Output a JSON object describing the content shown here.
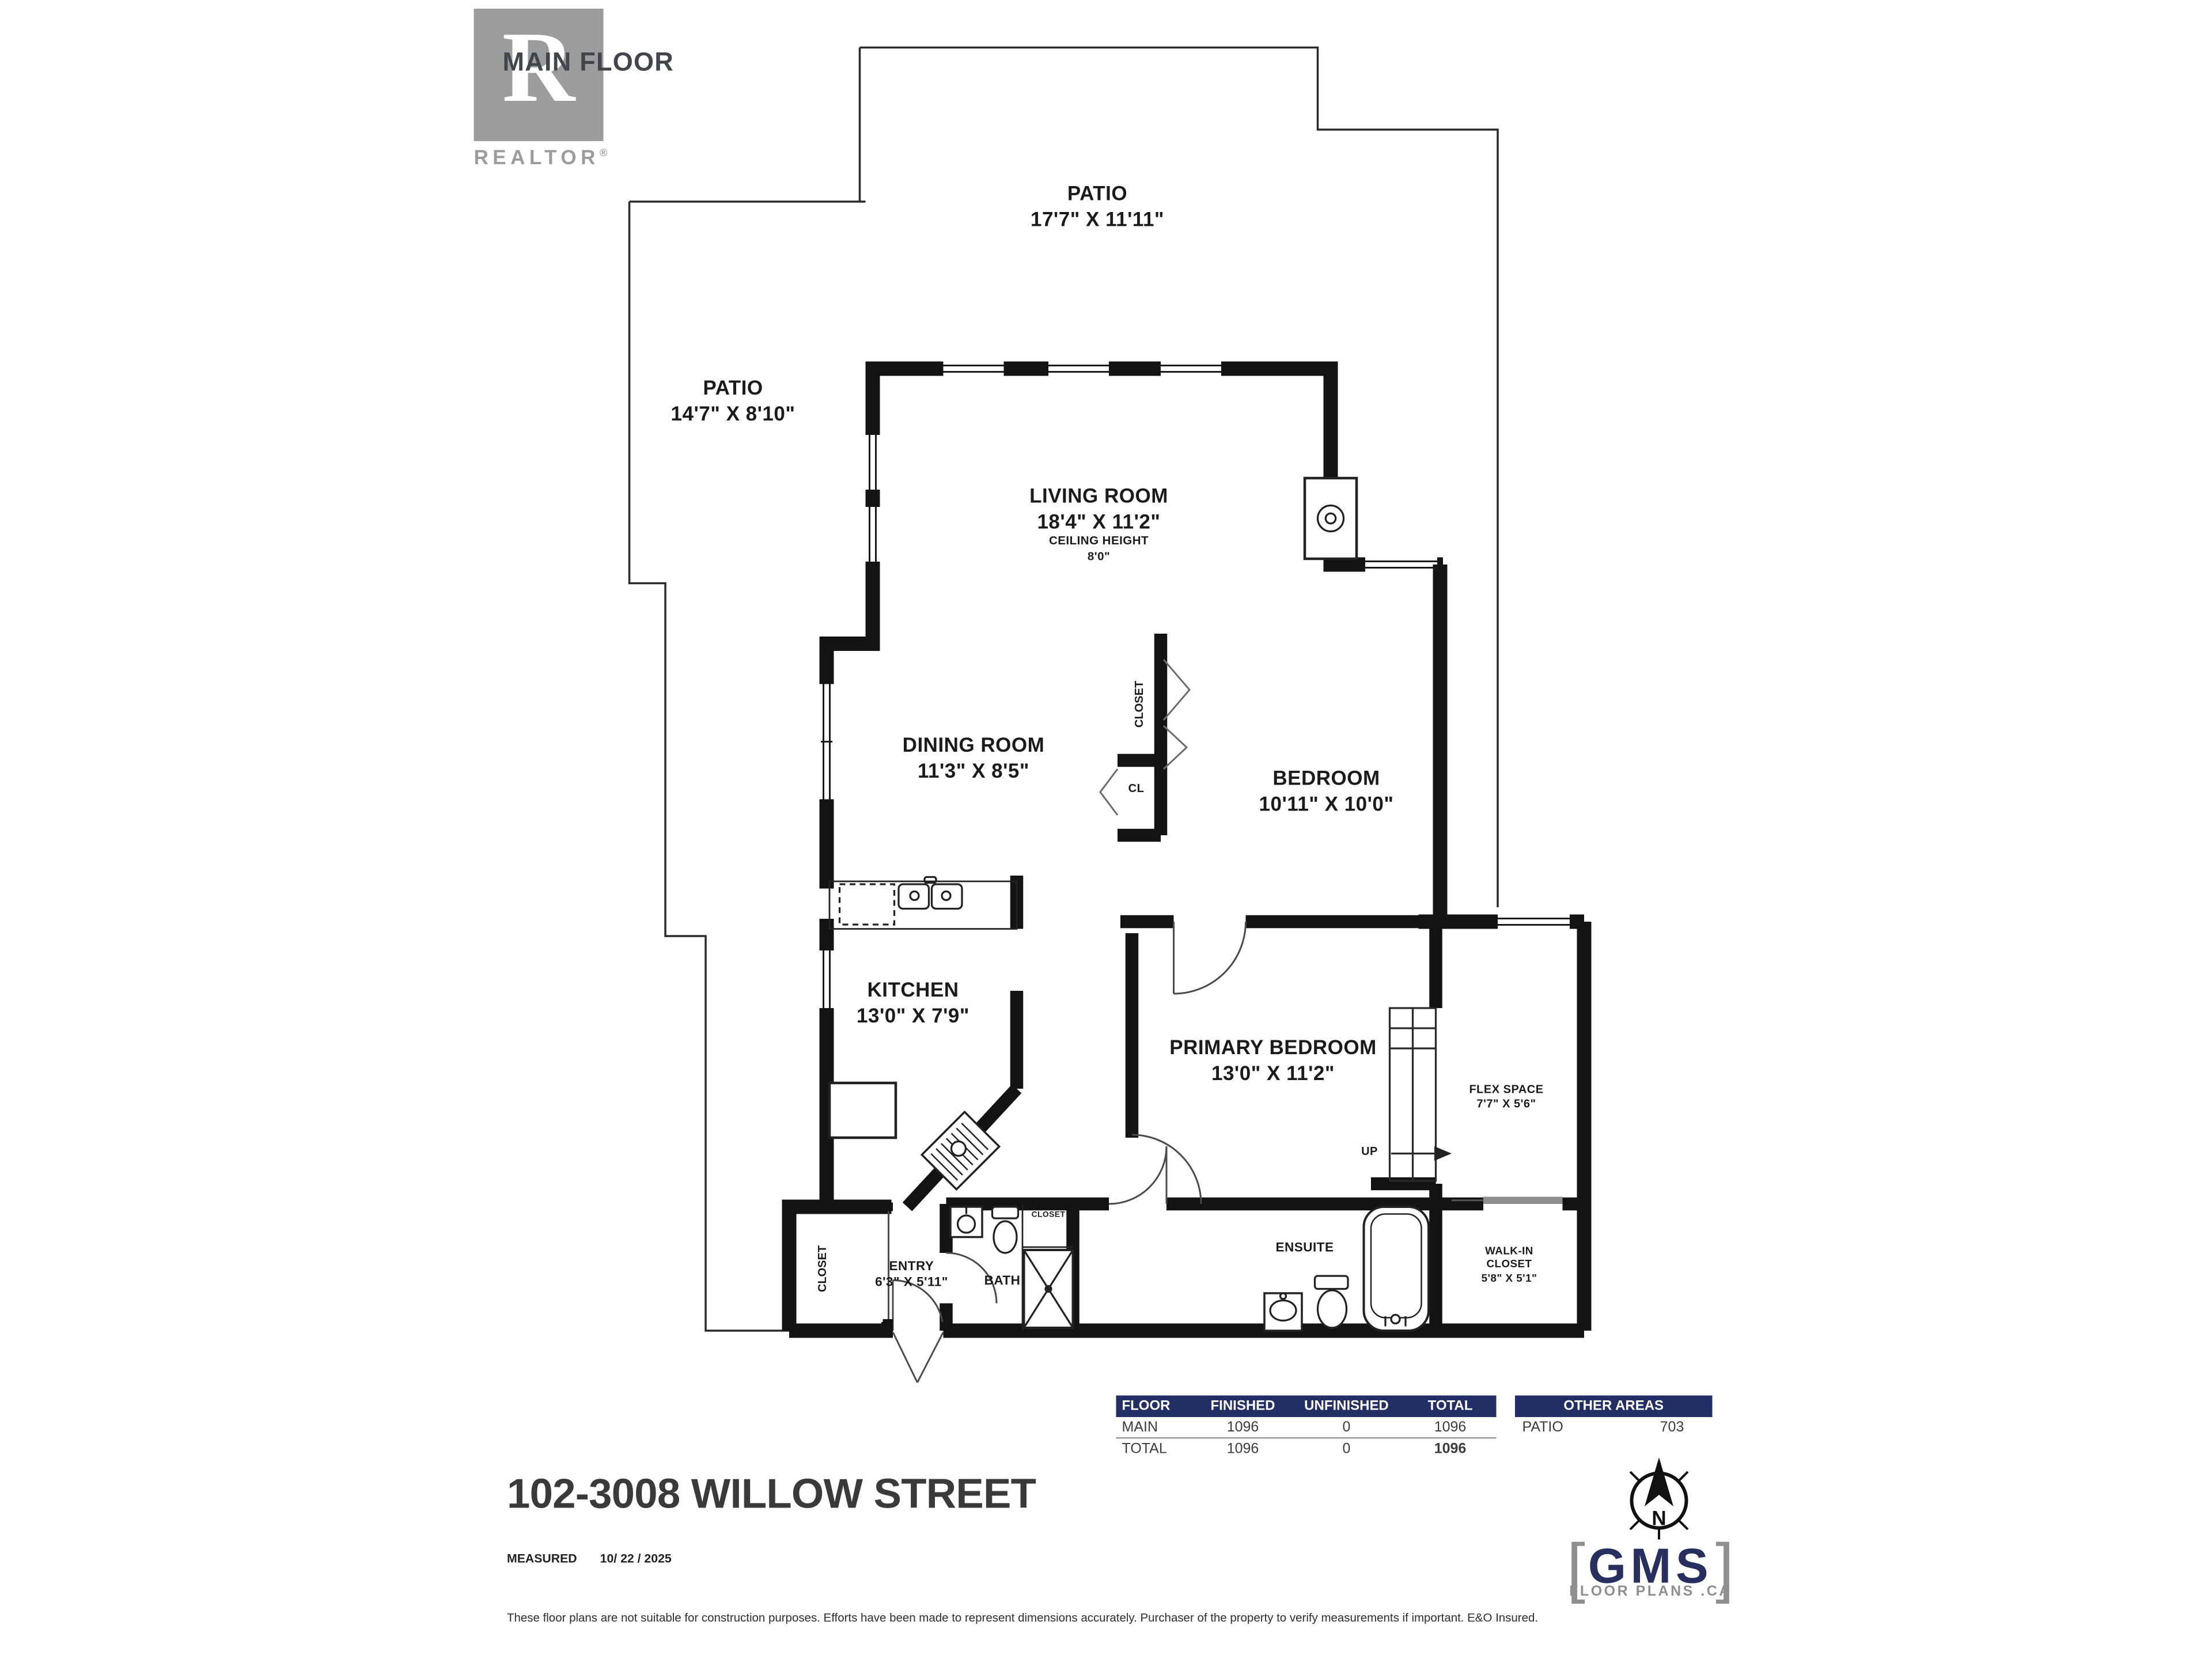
{
  "title_block": {
    "plan_label": "MAIN FLOOR",
    "realtor_mark": "R",
    "realtor_label": "REALTOR",
    "realtor_reg": "®"
  },
  "rooms": {
    "patio_top": {
      "name": "PATIO",
      "dims": "17'7\" X 11'11\""
    },
    "patio_left": {
      "name": "PATIO",
      "dims": "14'7\" X 8'10\""
    },
    "living": {
      "name": "LIVING ROOM",
      "dims": "18'4\" X 11'2\"",
      "ceiling_label": "CEILING HEIGHT",
      "ceiling_value": "8'0\""
    },
    "dining": {
      "name": "DINING ROOM",
      "dims": "11'3\" X 8'5\""
    },
    "bedroom": {
      "name": "BEDROOM",
      "dims": "10'11\" X 10'0\""
    },
    "kitchen": {
      "name": "KITCHEN",
      "dims": "13'0\" X 7'9\""
    },
    "primary": {
      "name": "PRIMARY BEDROOM",
      "dims": "13'0\" X 11'2\""
    },
    "flex": {
      "name": "FLEX SPACE",
      "dims": "7'7\" X 5'6\""
    },
    "entry": {
      "name": "ENTRY",
      "dims": "6'3\" X 5'11\""
    },
    "walk_in": {
      "line1": "WALK-IN",
      "line2": "CLOSET",
      "dims": "5'8\" X 5'1\""
    },
    "bath": {
      "name": "BATH"
    },
    "ensuite": {
      "name": "ENSUITE"
    }
  },
  "annotations": {
    "closet_dining": "CLOSET",
    "closet_small": "CL",
    "closet_entry": "CLOSET",
    "closet_bath": "CLOSET",
    "up": "UP"
  },
  "area_table": {
    "headers": [
      "FLOOR",
      "FINISHED",
      "UNFINISHED",
      "TOTAL"
    ],
    "rows": [
      {
        "floor": "MAIN",
        "finished": "1096",
        "unfinished": "0",
        "total": "1096"
      },
      {
        "floor": "TOTAL",
        "finished": "1096",
        "unfinished": "0",
        "total": "1096"
      }
    ],
    "other": {
      "header": "OTHER AREAS",
      "label": "PATIO",
      "value": "703"
    }
  },
  "footer": {
    "address": "102-3008 WILLOW STREET",
    "measured_label": "MEASURED",
    "measured_date": "10/ 22 / 2025",
    "disclaimer": "These floor plans are not suitable for construction purposes. Efforts have been made to represent dimensions accurately.  Purchaser of the property to verify measurements if important.  E&O Insured."
  },
  "branding": {
    "gms_name": "GMS",
    "gms_tagline": "FLOOR PLANS .CA",
    "compass_letter": "N",
    "bracket_left": "[",
    "bracket_right": "]"
  },
  "colors": {
    "navy": "#222f66",
    "gray": "#9c9c9c",
    "ink": "#1b1b1b"
  }
}
